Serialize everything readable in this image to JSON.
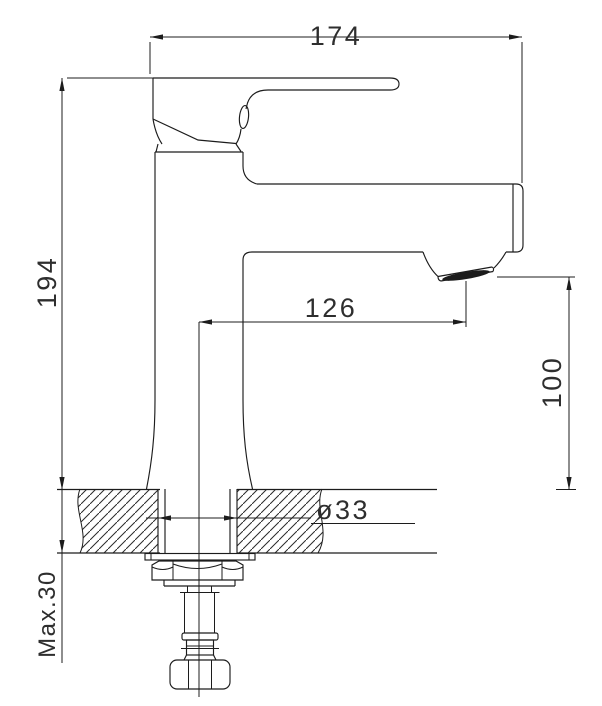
{
  "drawing": {
    "title": "faucet installation dimension drawing",
    "dims": {
      "overall_width": "174",
      "overall_height": "194",
      "spout_reach": "126",
      "spout_height": "100",
      "hole_diameter": "ø33",
      "max_deck_thickness": "Max.30"
    },
    "colors": {
      "background": "#ffffff",
      "line": "#1c1c1c",
      "text": "#2e2e2e",
      "aerator_fill": "#1c1c1c"
    }
  }
}
